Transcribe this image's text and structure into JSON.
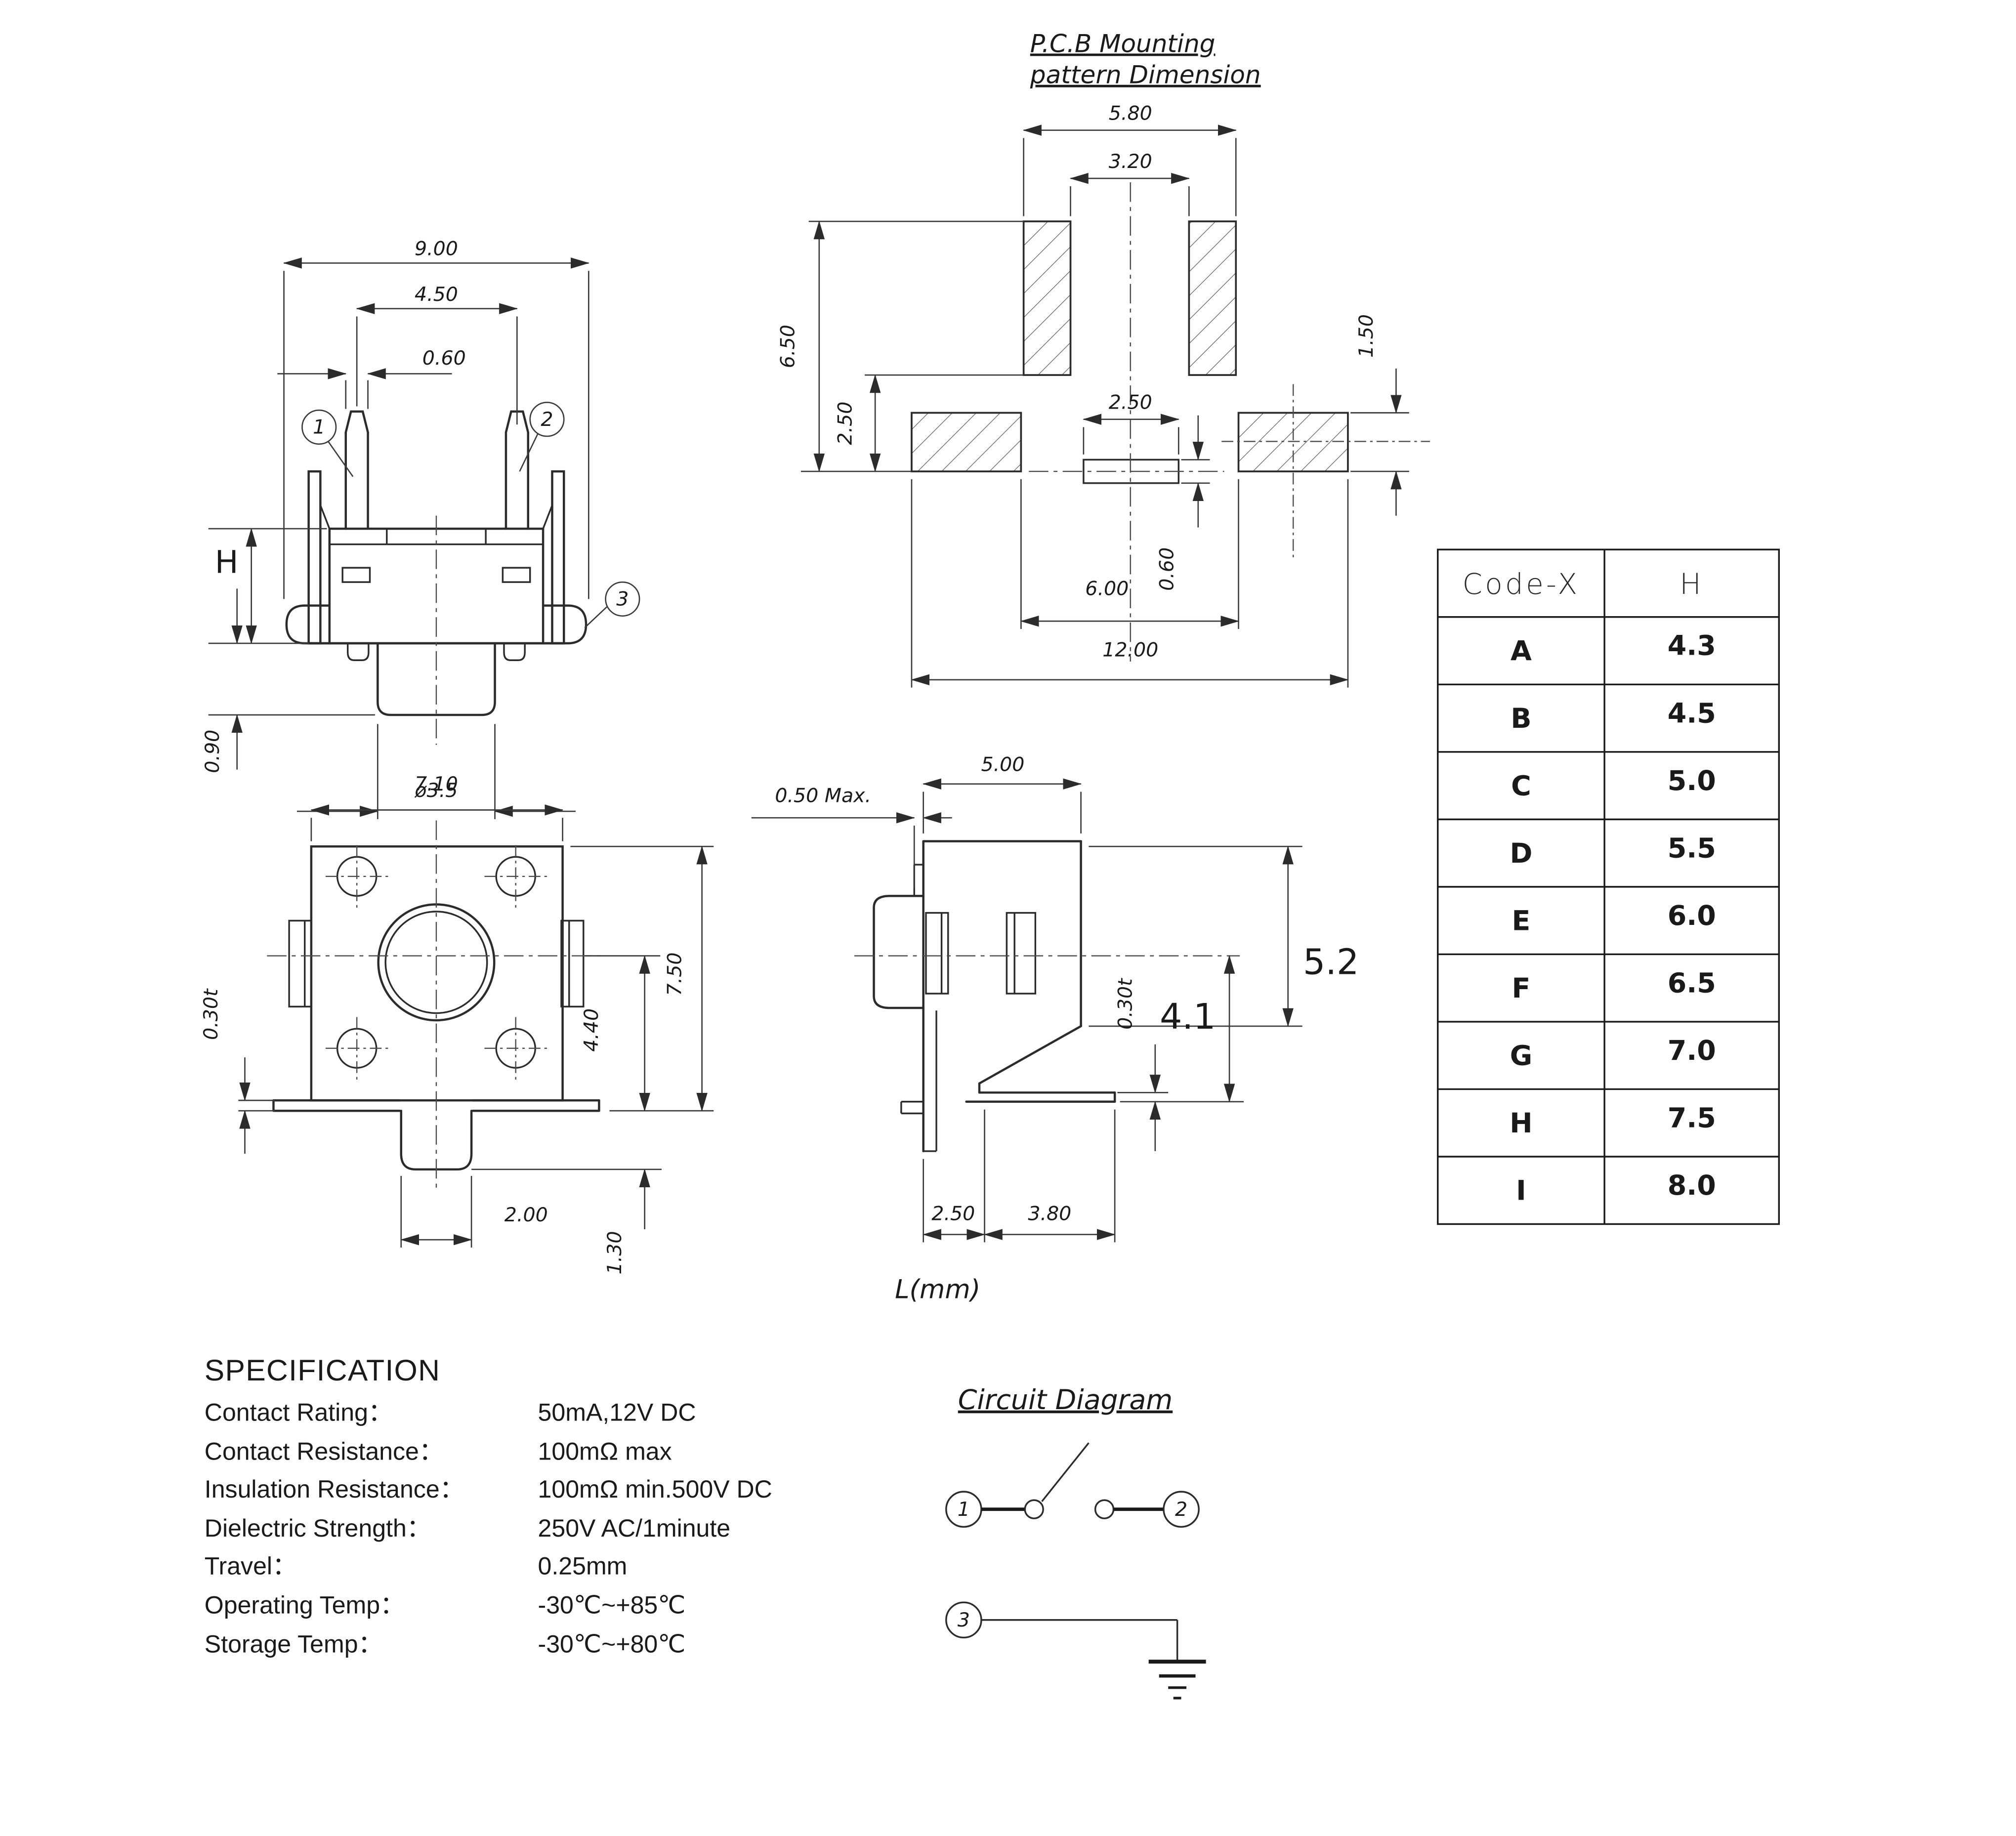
{
  "colors": {
    "ink": "#1a1a1a",
    "background": "#ffffff"
  },
  "front_view": {
    "balloon_1": "1",
    "balloon_2": "2",
    "balloon_3": "3",
    "dim_width": "9.00",
    "dim_pin_pitch": "4.50",
    "dim_pin_width": "0.60",
    "dim_height": "H",
    "dim_stem_height": "0.90",
    "dim_stem_dia": "ø3.5"
  },
  "pcb_pattern": {
    "title_line1": "P.C.B Mounting",
    "title_line2": "pattern Dimension",
    "dim_pad_outer": "5.80",
    "dim_pad_inner": "3.20",
    "dim_height_total": "6.50",
    "dim_pad_gap": "2.50",
    "dim_slot_width": "2.50",
    "dim_slot_height": "0.60",
    "dim_side_pad_height": "1.50",
    "dim_span_inner": "6.00",
    "dim_span_outer": "12.00"
  },
  "top_view": {
    "dim_width": "7.10",
    "dim_plate": "0.30t",
    "dim_height": "7.50",
    "dim_center_to_edge": "4.40",
    "dim_tab_width": "2.00",
    "dim_tab_depth": "1.30"
  },
  "side_view": {
    "dim_lip": "0.50  Max.",
    "dim_width": "5.00",
    "dim_total_height": "5.2",
    "dim_center_height": "4.1",
    "dim_plate": "0.30t",
    "dim_foot_a": "2.50",
    "dim_foot_b": "3.80",
    "unit_label": "L(mm)"
  },
  "table": {
    "col_code": "Code-X",
    "col_h": "H",
    "rows": [
      [
        "A",
        "4.3"
      ],
      [
        "B",
        "4.5"
      ],
      [
        "C",
        "5.0"
      ],
      [
        "D",
        "5.5"
      ],
      [
        "E",
        "6.0"
      ],
      [
        "F",
        "6.5"
      ],
      [
        "G",
        "7.0"
      ],
      [
        "H",
        "7.5"
      ],
      [
        "I",
        "8.0"
      ]
    ]
  },
  "spec": {
    "title": "SPECIFICATION",
    "rows": [
      {
        "label": "Contact  Rating：",
        "value": "50mA,12V DC"
      },
      {
        "label": "Contact  Resistance：",
        "value": "100mΩ max"
      },
      {
        "label": "Insulation Resistance：",
        "value": "100mΩ min.500V DC"
      },
      {
        "label": "Dielectric  Strength：",
        "value": "250V AC/1minute"
      },
      {
        "label": "Travel：",
        "value": "0.25mm"
      },
      {
        "label": "Operating Temp：",
        "value": "-30℃~+85℃"
      },
      {
        "label": "Storage Temp：",
        "value": "-30℃~+80℃"
      }
    ]
  },
  "circuit": {
    "title": "Circuit  Diagram",
    "terminal_1": "1",
    "terminal_2": "2",
    "terminal_3": "3"
  }
}
